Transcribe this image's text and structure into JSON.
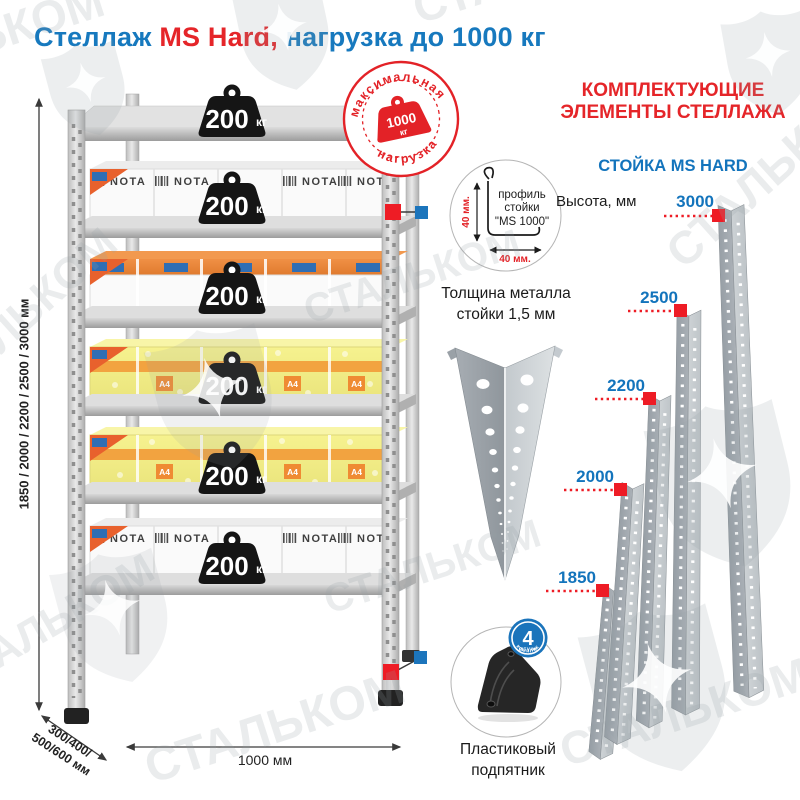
{
  "title": {
    "word1": "Стеллаж",
    "word2": "MS Hard,",
    "word3": "нагрузка до 1000 кг"
  },
  "watermark": {
    "brand": "СТАЛЬКОМ"
  },
  "max_load_badge": {
    "arc_top": "максимальная",
    "arc_bottom": "нагрузка",
    "value": "1000",
    "unit": "кг"
  },
  "shelf": {
    "load_value": "200",
    "load_unit": "кг",
    "box_brand": "NOTA",
    "box_paper_label": "A4",
    "height_options_label": "1850 / 2000 / 2200 / 2500 / 3000 мм",
    "depth_line1": "300/400/",
    "depth_line2": "500/600 мм",
    "width_label": "1000 мм"
  },
  "profile_detail": {
    "text_line1": "профиль",
    "text_line2": "стойки",
    "text_line3": "\"MS 1000\"",
    "dim_vertical": "40 мм.",
    "dim_horizontal": "40 мм.",
    "thickness_line1": "Толщина металла",
    "thickness_line2": "стойки 1,5 мм"
  },
  "foot_detail": {
    "label_line1": "Пластиковый",
    "label_line2": "подпятник",
    "qty_value": "4",
    "qty_word": "штуки",
    "qty_suffix": "в комплекте"
  },
  "components": {
    "heading_line1": "КОМПЛЕКТУЮЩИЕ",
    "heading_line2": "ЭЛЕМЕНТЫ СТЕЛЛАЖА",
    "subheading": "СТОЙКА MS HARD",
    "height_caption": "Высота, мм",
    "post_heights": [
      "3000",
      "2500",
      "2200",
      "2000",
      "1850"
    ]
  },
  "colors": {
    "blue": "#1374bc",
    "red": "#e52529",
    "marker_red": "#ee1c25",
    "marker_blue": "#1c75bc"
  }
}
